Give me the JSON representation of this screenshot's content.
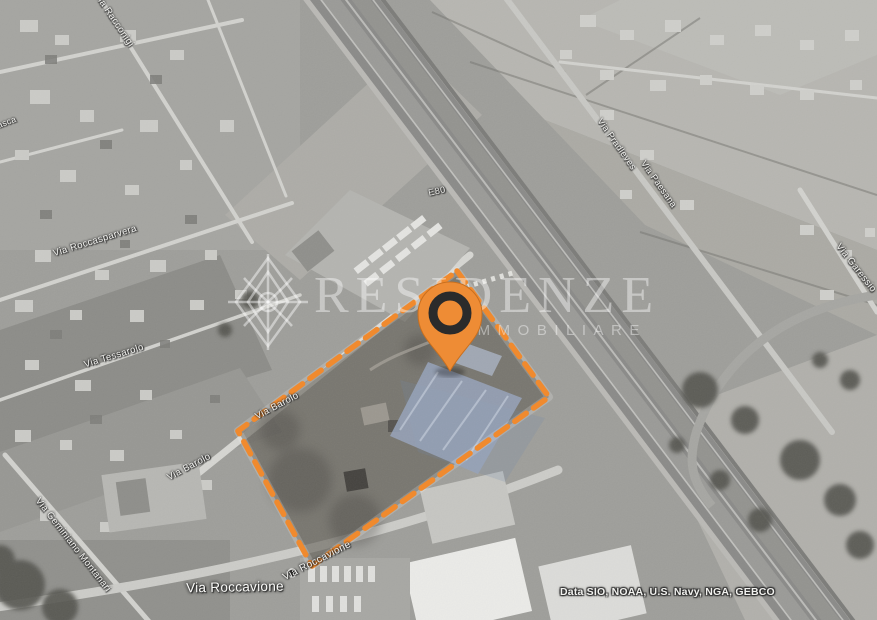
{
  "map": {
    "type": "satellite",
    "watermark": {
      "title": "RESIDENZE",
      "subtitle": "IMMOBILIARE"
    },
    "attribution": "Data SIO, NOAA, U.S. Navy, NGA, GEBCO",
    "highway_label": "E80",
    "street_labels": [
      {
        "name": "via-racconigi",
        "text": "Via Racconigi"
      },
      {
        "name": "via-cervasca",
        "text": "Via Cervasca"
      },
      {
        "name": "via-roccasparvera",
        "text": "Via Roccasparvera"
      },
      {
        "name": "via-tessarolo",
        "text": "Via Tessarolo"
      },
      {
        "name": "via-geminiano-montanari",
        "text": "Via Geminiano Montanari"
      },
      {
        "name": "via-barolo-upper",
        "text": "Via Barolo"
      },
      {
        "name": "via-barolo-lower",
        "text": "Via Barolo"
      },
      {
        "name": "via-roccavione-main",
        "text": "Via Roccavione"
      },
      {
        "name": "via-roccavione-small",
        "text": "Via Roccavione"
      },
      {
        "name": "via-pradleves",
        "text": "Via Pradleves"
      },
      {
        "name": "via-paesana",
        "text": "Via Paesana"
      },
      {
        "name": "via-garessio",
        "text": "Via Garessio"
      }
    ],
    "boundary": {
      "points": "457,271 549,397 312,566 238,431",
      "color": "#f08a2e",
      "style": "dashed"
    },
    "marker": {
      "kind": "location-pin",
      "color": "#ee8c35",
      "ring_color": "#2b2b2b"
    },
    "accent_colors": {
      "boundary_orange": "#f08a2e",
      "site_blue_tint": "#8fa0bb"
    }
  }
}
